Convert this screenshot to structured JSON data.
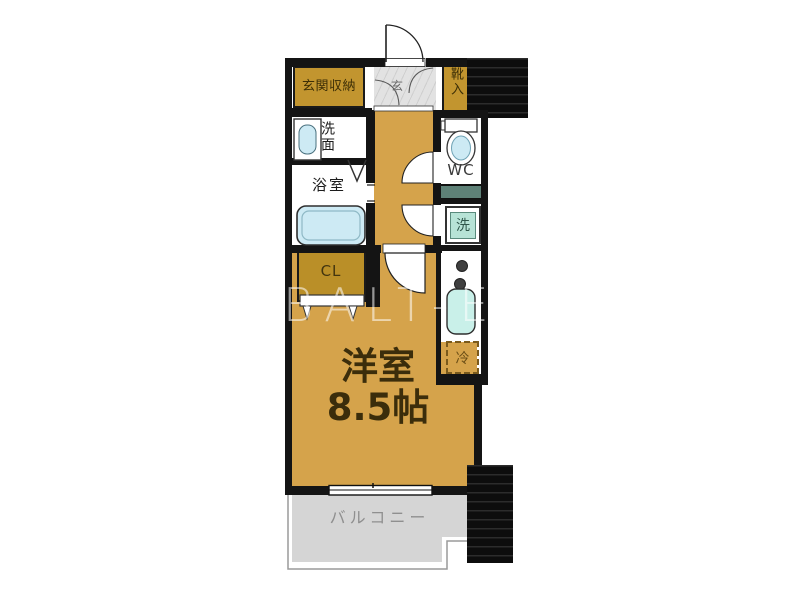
{
  "floorplan": {
    "watermark": "BALT-E",
    "rooms": {
      "entrance_storage": {
        "label": "玄関収納"
      },
      "entrance": {
        "label": "玄"
      },
      "shoe_cabinet": {
        "label": "靴入"
      },
      "washbasin": {
        "label": "洗面"
      },
      "bathroom": {
        "label": "浴室"
      },
      "toilet": {
        "label": "WC"
      },
      "laundry": {
        "label": "洗"
      },
      "closet": {
        "label": "CL"
      },
      "western_room": {
        "label": "洋室",
        "size": "8.5帖"
      },
      "refrigerator": {
        "label": "冷"
      },
      "balcony": {
        "label": "バルコニー"
      }
    },
    "colors": {
      "floor": "#D5A34B",
      "storage": "#C2952F",
      "wall": "#141414",
      "balcony": "#D5D5D5",
      "fixture_blue": "#CDEAF4",
      "kitchen_sink": "#C9F0E9",
      "laundry_teal": "#B7E3D6",
      "counter_teal": "#5E8177"
    }
  }
}
